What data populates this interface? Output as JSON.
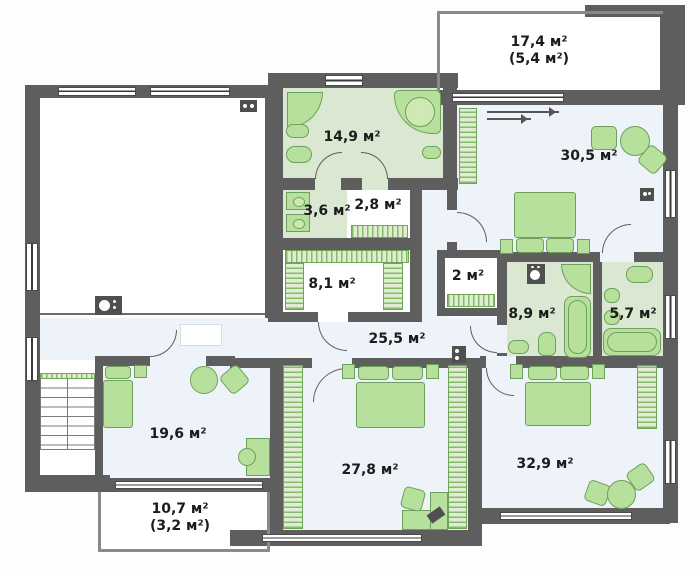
{
  "title": "Floor plan — second storey",
  "colors": {
    "wall": "#5e5e5e",
    "room_floor": "#edf3f8",
    "bath_floor": "#dbe8d1",
    "furniture": "#b7e09d",
    "furniture_border": "#6da05a",
    "label_text": "#1c1c1c"
  },
  "rooms": {
    "bath_main": {
      "label": "14,9 м²"
    },
    "wc": {
      "label": "3,6 м²"
    },
    "storage_small": {
      "label": "2,8 м²"
    },
    "wardrobe_room": {
      "label": "8,1 м²"
    },
    "balcony_top": {
      "label": "17,4 м²",
      "sublabel": "(5,4 м²)"
    },
    "bedroom_master": {
      "label": "30,5 м²"
    },
    "closet": {
      "label": "2 м²"
    },
    "bath_family": {
      "label": "8,9 м²"
    },
    "bath_ensuite": {
      "label": "5,7 м²"
    },
    "hall": {
      "label": "25,5 м²"
    },
    "bedroom_left": {
      "label": "19,6 м²"
    },
    "bedroom_middle": {
      "label": "27,8 м²"
    },
    "bedroom_right": {
      "label": "32,9 м²"
    },
    "balcony_bottom": {
      "label": "10,7 м²",
      "sublabel": "(3,2 м²)"
    }
  },
  "icons": {
    "entry_arrows": "direction-arrows",
    "vent": "ventilation-shaft",
    "boiler": "boiler-unit",
    "washer": "washing-machine"
  }
}
